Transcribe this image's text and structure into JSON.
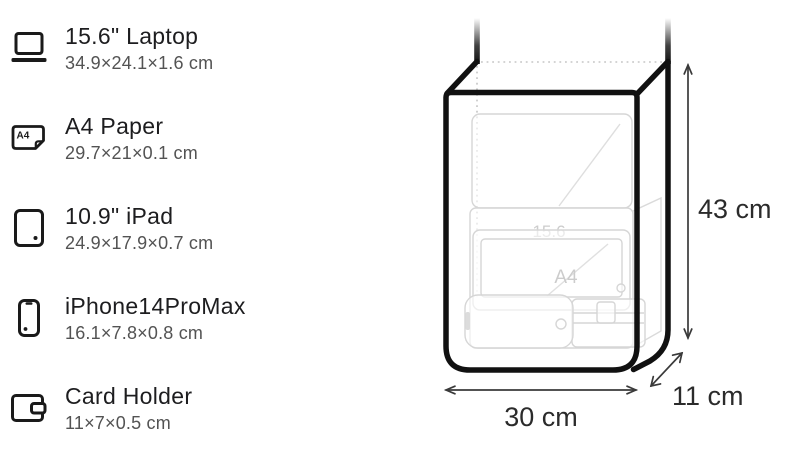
{
  "items": [
    {
      "name": "15.6\" Laptop",
      "dims": "34.9×24.1×1.6 cm",
      "icon": "laptop-icon"
    },
    {
      "name": "A4 Paper",
      "dims": "29.7×21×0.1 cm",
      "icon": "a4-paper-icon"
    },
    {
      "name": "10.9\" iPad",
      "dims": "24.9×17.9×0.7 cm",
      "icon": "ipad-icon"
    },
    {
      "name": "iPhone14ProMax",
      "dims": "16.1×7.8×0.8 cm",
      "icon": "iphone-icon"
    },
    {
      "name": "Card Holder",
      "dims": "11×7×0.5 cm",
      "icon": "card-holder-icon"
    }
  ],
  "a4_icon_label": "A4",
  "diagram": {
    "height_label": "43 cm",
    "width_label": "30 cm",
    "depth_label": "11 cm",
    "inner_labels": {
      "laptop": "15.6",
      "a4": "A4"
    },
    "colors": {
      "outline": "#111111",
      "faint_stroke": "#d6d6d6",
      "dotted": "#c5c5c5",
      "arrow": "#3a3a3a",
      "label": "#2b2b2b"
    }
  }
}
